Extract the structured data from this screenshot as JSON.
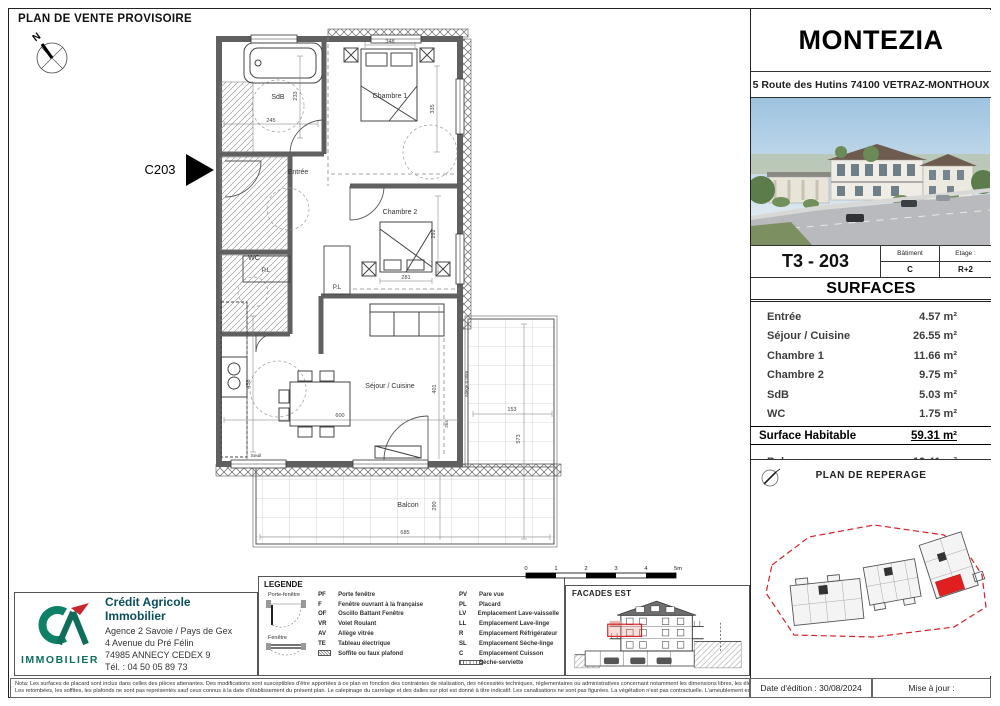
{
  "sheet": {
    "title": "PLAN DE VENTE PROVISOIRE",
    "note_line1": "Nota: Les surfaces de placard sont inclus dans celles des pièces attenantes. Des modifications sont susceptibles d'être apportées à ce plan en fonction des contraintes de réalisation, des nécessités techniques, réglementaires ou administratives concernant notamment les dimensions libres, les éléments d'équipements et les réseaux divers.",
    "note_line2": "Les retombées, les soffites, les plafonds ne sont pas représentés sauf ceux connus à la date d'établissement du présent plan. Le calepinage du carrelage et des dalles sur plot est donné à titre indicatif. Les canalisations ne sont pas figurées. La végétation n'est pas contractuelle. L'ameublement est également indicatif.",
    "date_edition": "Date d'édition : 30/08/2024",
    "mise_a_jour": "Mise à jour :"
  },
  "header": {
    "project": "MONTEZIA",
    "address": "5 Route des Hutins 74100 VETRAZ-MONTHOUX"
  },
  "unit": {
    "code": "T3 - 203",
    "batiment_label": "Bâtiment",
    "batiment": "C",
    "etage_label": "Etage :",
    "etage": "R+2"
  },
  "surfaces": {
    "title": "SURFACES",
    "rows": [
      {
        "label": "Entrée",
        "value": "4.57 m²"
      },
      {
        "label": "Séjour / Cuisine",
        "value": "26.55 m²"
      },
      {
        "label": "Chambre 1",
        "value": "11.66 m²"
      },
      {
        "label": "Chambre 2",
        "value": "9.75 m²"
      },
      {
        "label": "SdB",
        "value": "5.03 m²"
      },
      {
        "label": "WC",
        "value": "1.75 m²"
      }
    ],
    "total_label": "Surface Habitable",
    "total_value": "59.31 m²",
    "balcon_label": "Balcon",
    "balcon_value": "19.41 m²"
  },
  "reperage": {
    "title": "PLAN DE REPERAGE"
  },
  "agency": {
    "name": "Crédit Agricole Immobilier",
    "line1": "Agence 2 Savoie / Pays de Gex",
    "line2": "4 Avenue du Pré Félin",
    "line3": "74985 ANNECY CEDEX 9",
    "line4": "Tél. : 04 50 05 89 73",
    "logo_caption": "IMMOBILIER"
  },
  "legende": {
    "title": "LEGENDE",
    "drawing1_label": "Porte-fenêtre",
    "drawing2_label": "Fenêtre",
    "left": [
      {
        "abbr": "PF",
        "label": "Porte fenêtre"
      },
      {
        "abbr": "F",
        "label": "Fenêtre ouvrant à la française"
      },
      {
        "abbr": "OF",
        "label": "Oscillo Battant Fenêtre"
      },
      {
        "abbr": "VR",
        "label": "Volet Roulant"
      },
      {
        "abbr": "AV",
        "label": "Allège vitrée"
      },
      {
        "abbr": "TE",
        "label": "Tableau électrique"
      },
      {
        "abbr": "",
        "label": "Soffite ou faux plafond"
      }
    ],
    "right": [
      {
        "abbr": "PV",
        "label": "Pare vue"
      },
      {
        "abbr": "PL",
        "label": "Placard"
      },
      {
        "abbr": "LV",
        "label": "Emplacement Lave-vaisselle"
      },
      {
        "abbr": "LL",
        "label": "Emplacement Lave-linge"
      },
      {
        "abbr": "R",
        "label": "Emplacement Réfrigérateur"
      },
      {
        "abbr": "SL",
        "label": "Emplacement Sèche-linge"
      },
      {
        "abbr": "C",
        "label": "Emplacement Cuisson"
      },
      {
        "abbr": "",
        "label": "Sèche-serviette"
      }
    ]
  },
  "facade": {
    "title": "FACADES EST"
  },
  "scalebar": {
    "t0": "0",
    "t1": "1",
    "t2": "2",
    "t3": "3",
    "t4": "4",
    "t5": "5m"
  },
  "plan": {
    "marker": "C203",
    "compass_n": "N",
    "rooms": {
      "sdb": "SdB",
      "ch1": "Chambre 1",
      "ch2": "Chambre 2",
      "entree": "Entrée",
      "wc": "WC",
      "sejour": "Séjour / Cuisine",
      "balcon": "Balcon",
      "pl": "P.L",
      "seuil": "Seuil",
      "allege": "Allège 0.90m"
    },
    "dims": {
      "d245": "245",
      "d233": "233",
      "d348": "348",
      "d335": "335",
      "d292": "292",
      "d281": "281",
      "d458": "458",
      "d600": "600",
      "d401": "401",
      "d364": "364",
      "d153": "153",
      "d573": "573",
      "d685": "685",
      "d290": "290"
    }
  },
  "colors": {
    "accent_red": "#d32127",
    "ca_green": "#0f8068",
    "ca_red": "#c9252c",
    "wall_gray": "#606060"
  }
}
